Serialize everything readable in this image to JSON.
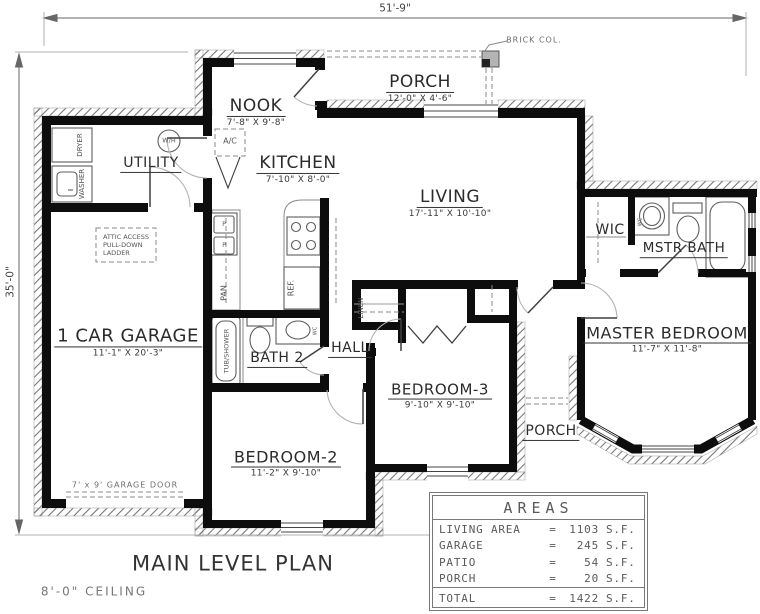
{
  "drawing": {
    "title": "MAIN LEVEL PLAN",
    "ceiling_note": "8'-0\" CEILING",
    "overall_width": "51'-9\"",
    "overall_depth": "35'-0\""
  },
  "rooms": {
    "porch_front": {
      "name": "PORCH",
      "size": "12'-0\" X 4'-6\""
    },
    "nook": {
      "name": "NOOK",
      "size": "7'-8\" X 9'-8\""
    },
    "kitchen": {
      "name": "KITCHEN",
      "size": "7'-10\" X 8'-0\""
    },
    "living": {
      "name": "LIVING",
      "size": "17'-11\" X 10'-10\""
    },
    "utility": {
      "name": "UTILITY"
    },
    "garage": {
      "name": "1 CAR GARAGE",
      "size": "11'-1\" X 20'-3\""
    },
    "bath2": {
      "name": "BATH 2"
    },
    "hall": {
      "name": "HALL"
    },
    "wic": {
      "name": "WIC"
    },
    "mstr_bath": {
      "name": "MSTR BATH"
    },
    "master_bedroom": {
      "name": "MASTER BEDROOM",
      "size": "11'-7\" X 11'-8\""
    },
    "bedroom2": {
      "name": "BEDROOM-2",
      "size": "11'-2\" X 9'-10\""
    },
    "bedroom3": {
      "name": "BEDROOM-3",
      "size": "9'-10\" X 9'-10\""
    },
    "porch_rear": {
      "name": "PORCH"
    }
  },
  "fixtures": {
    "dryer": "DRYER",
    "washer": "WASHER",
    "water_heater": "W/H",
    "ac": "A/C",
    "pantry": "PAN",
    "refrigerator": "REF.",
    "tub_shower": "TUB/SHOWER",
    "linen": "LINEN",
    "wc": "WC",
    "sink_p": "P"
  },
  "notes": {
    "brick_col": "BRICK COL.",
    "garage_door": "7' x 9' GARAGE DOOR",
    "attic_line1": "ATTIC ACCESS",
    "attic_line2": "PULL-DOWN",
    "attic_line3": "LADDER"
  },
  "areas_table": {
    "title": "AREAS",
    "rows": [
      {
        "label": "LIVING AREA",
        "eq": "=",
        "value": "1103",
        "unit": "S.F."
      },
      {
        "label": "GARAGE",
        "eq": "=",
        "value": "245",
        "unit": "S.F."
      },
      {
        "label": "PATIO",
        "eq": "=",
        "value": "54",
        "unit": "S.F."
      },
      {
        "label": "PORCH",
        "eq": "=",
        "value": "20",
        "unit": "S.F."
      }
    ],
    "total": {
      "label": "TOTAL",
      "eq": "=",
      "value": "1422",
      "unit": "S.F."
    }
  }
}
